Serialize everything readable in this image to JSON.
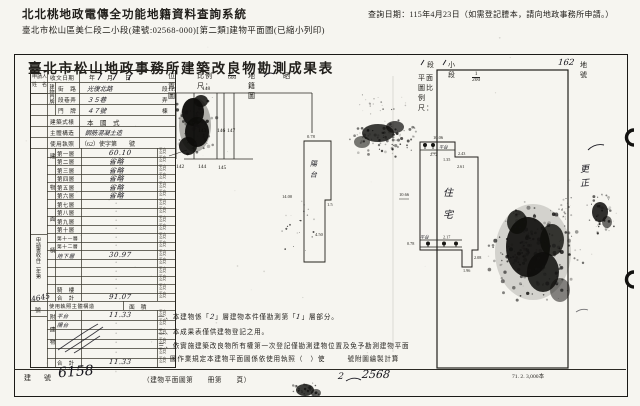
{
  "header": {
    "system_title": "北北桃地政電傳全功能地籍資料查詢系統",
    "query_date": "查詢日期：115年4月23日（如需登記謄本，請向地政事務所申請。）",
    "doc_line": "臺北市松山區美仁段二小段(建號:02568-000)[第二類]建物平面圖(已縮小列印)"
  },
  "form": {
    "title": "臺北市松山地政事務所建築改良物勘測成果表",
    "land": {
      "duan": "段",
      "xiaoduan": "小段",
      "dihao_hw": "162",
      "dihao": "地號"
    },
    "loc_scale": {
      "label": "位置圖",
      "ratio_label": "比例尺：",
      "num": "1",
      "den": "600",
      "map_label": "地籍圖",
      "extra": "晒"
    },
    "plan_scale": {
      "label": "平面圖比例尺：",
      "num": "1",
      "den": "200"
    },
    "print_note": "71. 2. 3,000本"
  },
  "table": {
    "applicant_l1": "申請人",
    "applicant_l2": "姓　名",
    "receipt": {
      "label": "收文日期",
      "value": "年　　月　　日"
    },
    "addr_group": "建物門牌",
    "addr_rows": [
      {
        "label": "街　路",
        "value": "光復北路",
        "suffix": "段",
        "hw": true
      },
      {
        "label": "段巷弄",
        "value": "３５巷",
        "suffix": "弄",
        "hw": true
      },
      {
        "label": "門　牌",
        "value": "４７號",
        "suffix": "棟",
        "hw": true
      }
    ],
    "style": {
      "label": "建築式樣",
      "value": "本　國　式"
    },
    "structure": {
      "label": "主體構造",
      "value": "鋼筋混凝土造"
    },
    "license": {
      "label": "使用執照",
      "value": "（62）使字第　　號"
    },
    "floor_group": "建物面積",
    "unit": "平方公尺",
    "floors": [
      {
        "label": "第一層",
        "value": "60.10",
        "hw_value": true
      },
      {
        "label": "第二層",
        "value": "省略",
        "hw_value": true
      },
      {
        "label": "第三層",
        "value": "省略",
        "hw_value": true
      },
      {
        "label": "第四層",
        "value": "省略",
        "hw_value": true
      },
      {
        "label": "第五層",
        "value": "省略",
        "hw_value": true
      },
      {
        "label": "第六層",
        "value": "省略",
        "hw_value": true
      },
      {
        "label": "第七層",
        "value": "·"
      },
      {
        "label": "第八層",
        "value": "·"
      },
      {
        "label": "第九層",
        "value": "·"
      },
      {
        "label": "第十層",
        "value": "·"
      },
      {
        "label": "第十一層",
        "value": "·"
      },
      {
        "label": "第十二層",
        "value": "·"
      },
      {
        "label": "地下層",
        "value": "30.97",
        "hw_value": true,
        "hw_label": true
      },
      {
        "label": "",
        "value": "·"
      },
      {
        "label": "",
        "value": "·"
      },
      {
        "label": "",
        "value": "·"
      },
      {
        "label": "騎　樓",
        "value": "·"
      },
      {
        "label": "合　計",
        "value": "91.07",
        "hw_value": true
      }
    ],
    "license_row": {
      "label": "使用執照主體構造",
      "value": "面　積"
    },
    "attached_group": "附建物",
    "attached": [
      {
        "label": "平台",
        "value": "11.33",
        "hw_value": true,
        "hw_label": true
      },
      {
        "label": "陽台",
        "value": "·",
        "hw_label": true
      },
      {
        "label": "",
        "value": "·"
      },
      {
        "label": "",
        "value": "·"
      },
      {
        "label": "",
        "value": "·"
      },
      {
        "label": "合　計",
        "value": "11.33",
        "hw_value": true
      }
    ],
    "registry_vertical": "申請書收件二年第",
    "registry_hw": "4645",
    "registry_suffix": "號"
  },
  "bottom": {
    "jianhao_label": "建　號",
    "jianhao_hw": "6158",
    "book_label": "（建物平面圖第　　冊第　　頁）",
    "book_hw_a": "2",
    "book_hw_b": "2568"
  },
  "notes": {
    "n1_pre": "一、本建物係「",
    "n1_hw_a": "2",
    "n1_mid": "」層建物本件僅勘測第「",
    "n1_hw_b": "1",
    "n1_post": "」層部分。",
    "n2": "二、本成果表僅供建物登記之用。",
    "n3": "三、依實施建築改良物所有權第一次登記僅勘測建物位置及免予勘測建物平面",
    "n4": "圖作業規定本建物平面圖係依使用執照（　）使　　　號附圖繪製計算"
  },
  "sketch": {
    "lots_top": [
      "147",
      "148"
    ],
    "lots_mid": [
      "143",
      "146",
      "147"
    ],
    "lots_bottom": [
      "142",
      "144",
      "145"
    ],
    "narrow_plan": {
      "room_c1": "陽",
      "room_c2": "台",
      "dim_top": "0.78",
      "dim_left": "14.00",
      "dim_mid": "1.5",
      "dim_low": "4.50"
    },
    "main_plan": {
      "room_c1": "住",
      "room_c2": "宅",
      "platform_top": "平台",
      "platform_bottom": "平台",
      "dim_top": "10.06",
      "dim_p_top": "2.72",
      "dim_n1": "1.35",
      "dim_n2": "2.43",
      "dim_n3": "2.61",
      "dim_left": "10.66",
      "dim_p_bot": "2.17",
      "dim_p_left": "0.78",
      "dim_t1": "2.08",
      "dim_t2": "1.96"
    },
    "margin_hw_c1": "更",
    "margin_hw_c2": "正"
  }
}
